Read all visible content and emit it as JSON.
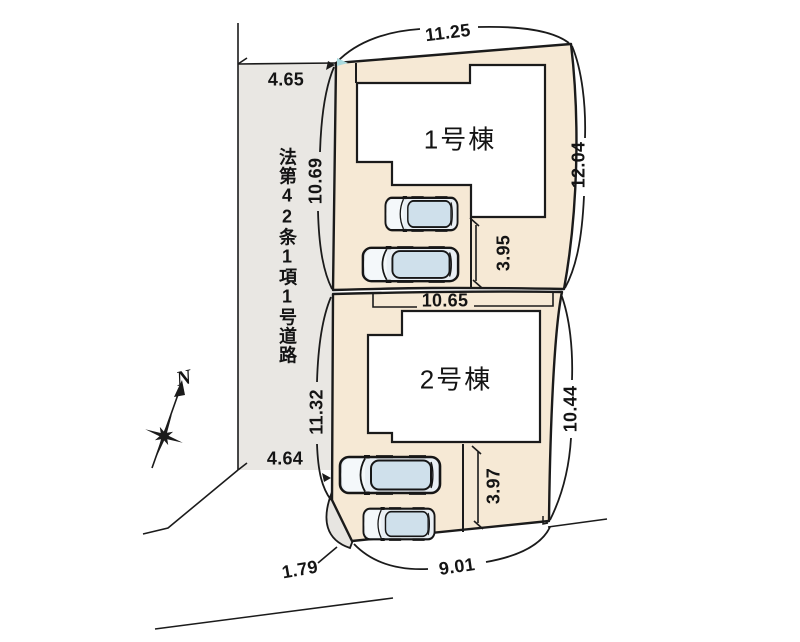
{
  "plan": {
    "north_label": "N",
    "road_label": "法第42条1項1号道路",
    "buildings": [
      {
        "label": "1号棟"
      },
      {
        "label": "2号棟"
      }
    ],
    "dims": {
      "road_width_top": "4.65",
      "road_width_bottom": "4.64",
      "lot1_top": "11.25",
      "lot1_left": "10.69",
      "lot1_right": "12.04",
      "lot1_parking": "3.95",
      "divider": "10.65",
      "lot2_left": "11.32",
      "lot2_right": "10.44",
      "lot2_parking": "3.97",
      "lot2_bottom": "9.01",
      "corner_cut": "1.79"
    },
    "colors": {
      "lot_fill": "#f6e9d5",
      "road_fill": "#e9e7e3",
      "wedge_fill": "#e7e5e1",
      "line": "#1b1b1b",
      "building_fill": "#ffffff",
      "car_body": "#e9eff4",
      "car_roof": "#cfe0eb",
      "corner_accent": "#aadade"
    }
  }
}
